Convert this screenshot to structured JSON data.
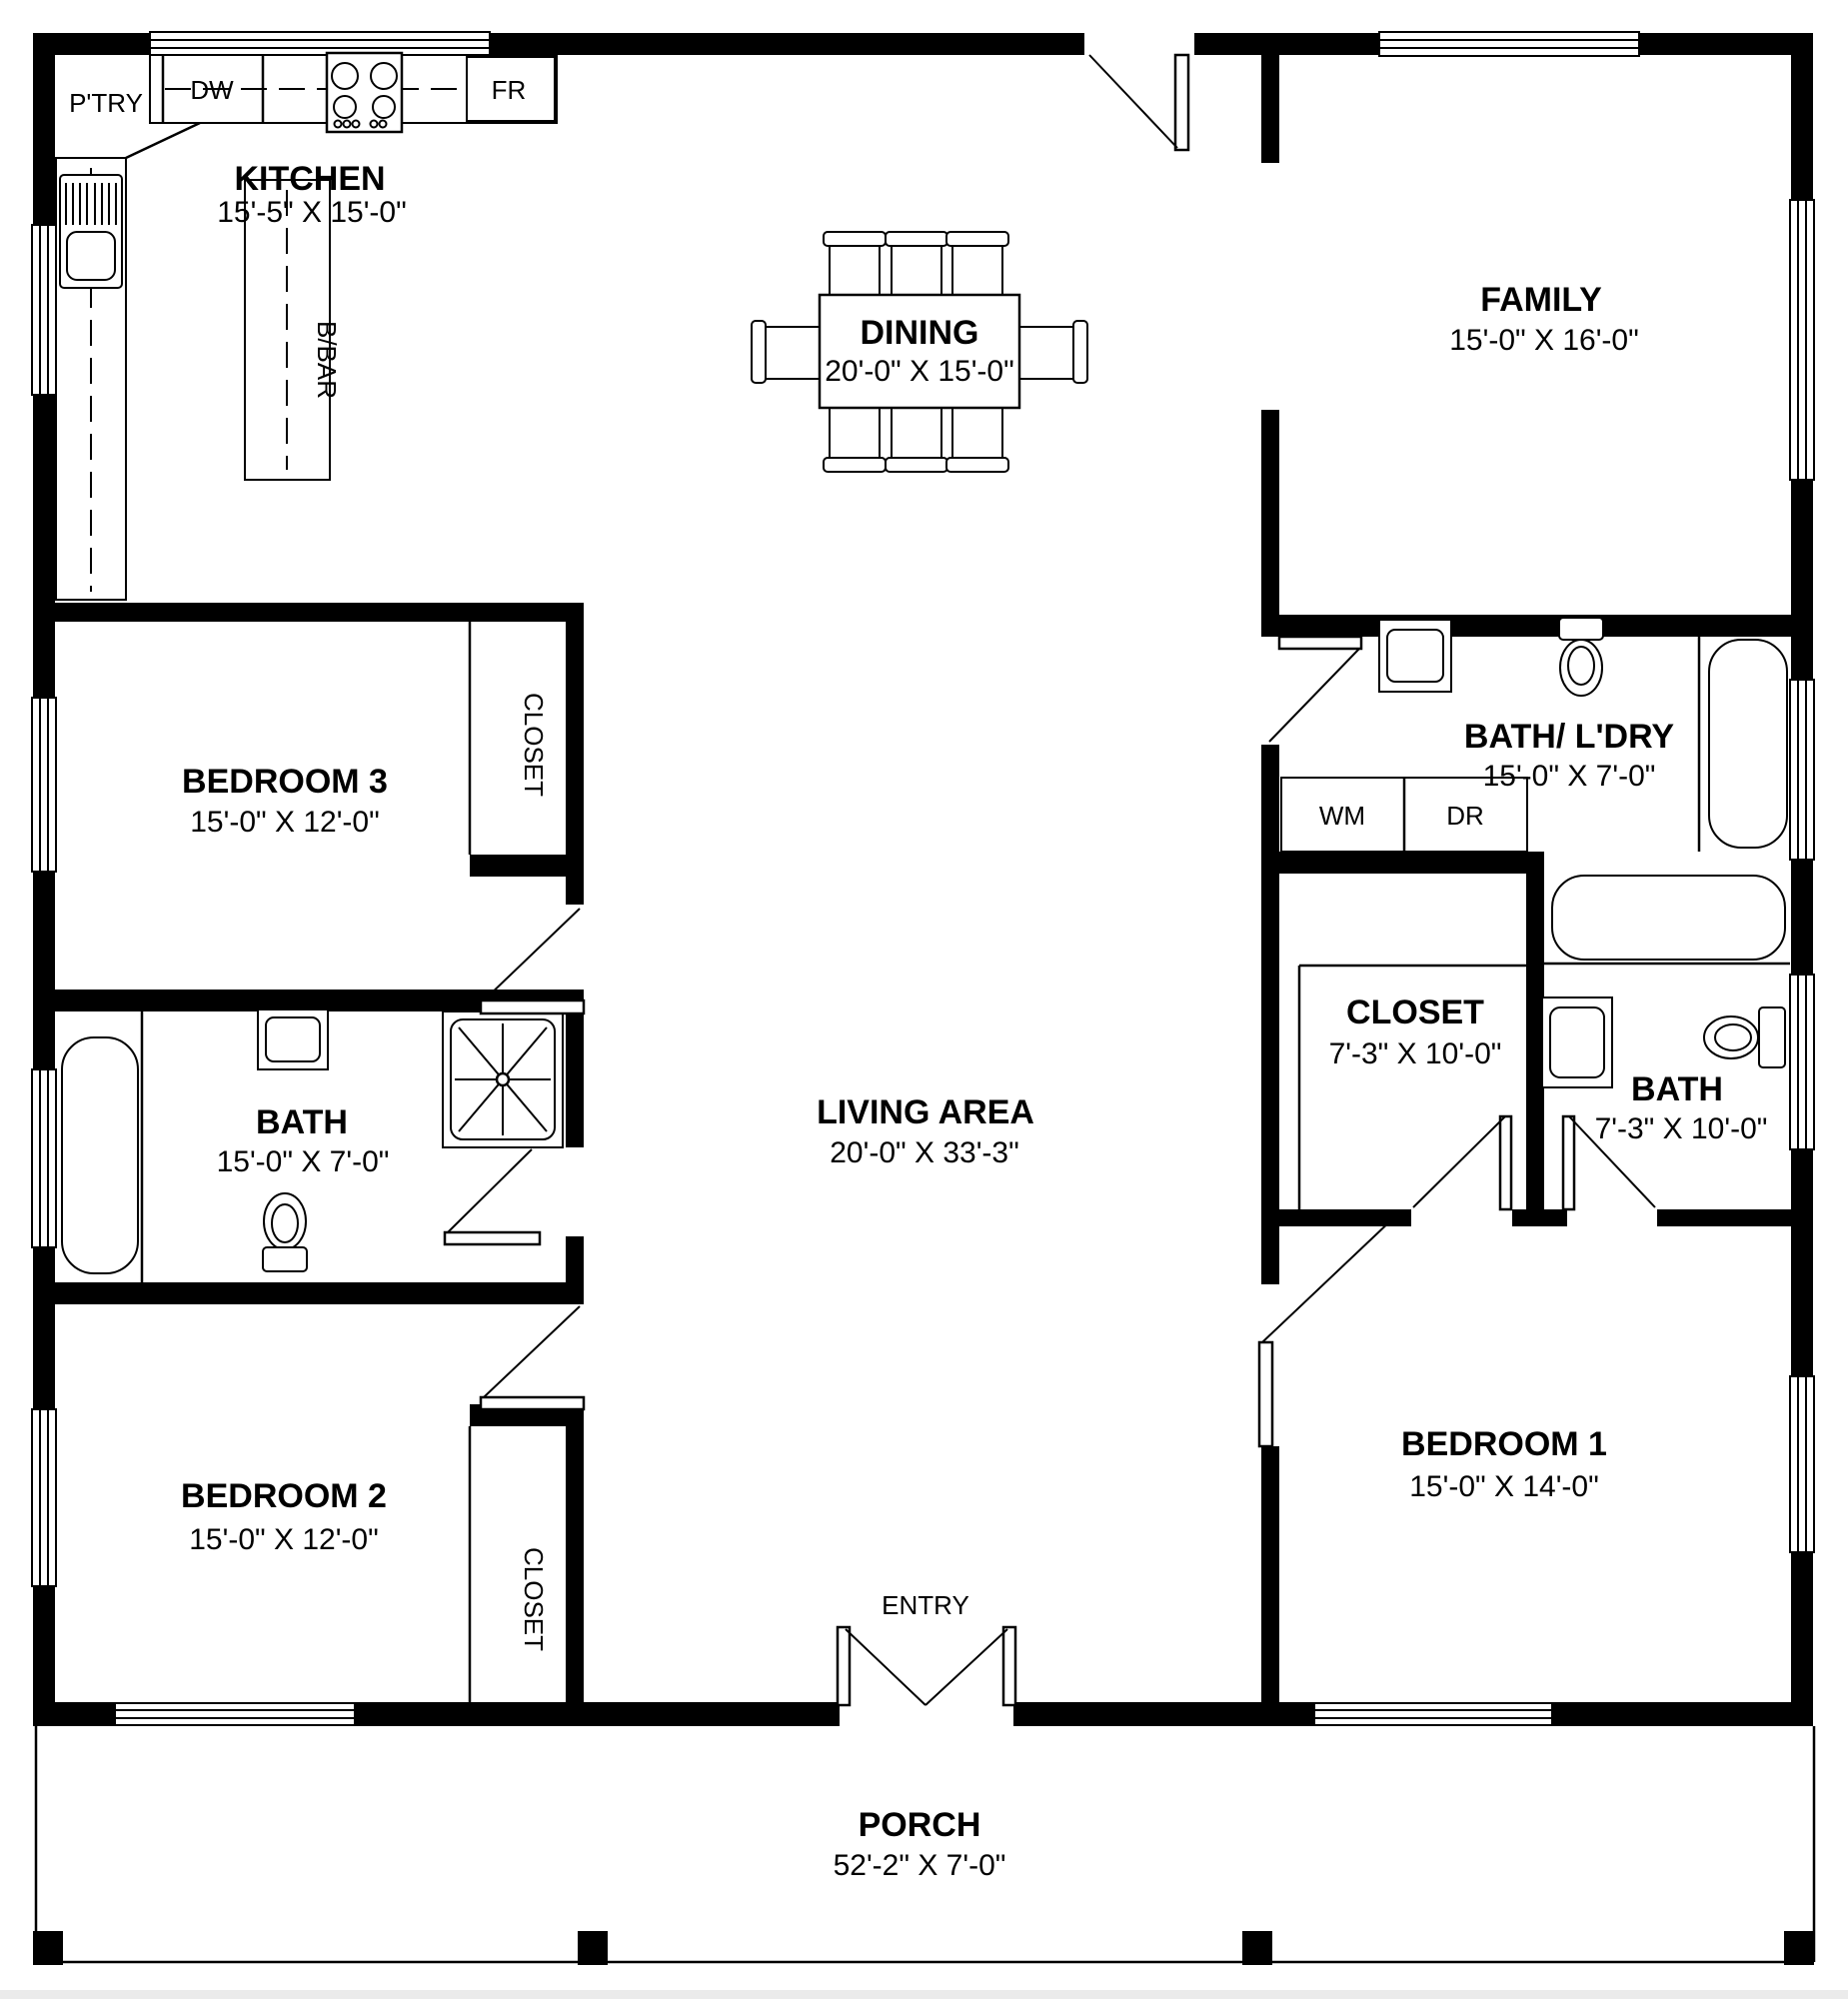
{
  "colors": {
    "wall": "#000000",
    "background": "#ffffff",
    "footer_strip": "#ebebeb"
  },
  "rooms": {
    "kitchen": {
      "name": "KITCHEN",
      "dims": "15'-5\" X 15'-0\""
    },
    "dining": {
      "name": "DINING",
      "dims": "20'-0\" X 15'-0\""
    },
    "family": {
      "name": "FAMILY",
      "dims": "15'-0\" X 16'-0\""
    },
    "bedroom3": {
      "name": "BEDROOM 3",
      "dims": "15'-0\" X 12'-0\""
    },
    "bath_main": {
      "name": "BATH",
      "dims": "15'-0\" X 7'-0\""
    },
    "bedroom2": {
      "name": "BEDROOM 2",
      "dims": "15'-0\" X 12'-0\""
    },
    "living": {
      "name": "LIVING AREA",
      "dims": "20'-0\" X 33'-3\""
    },
    "bath_laundry": {
      "name": "BATH/ L'DRY",
      "dims": "15'-0\" X 7'-0\""
    },
    "closet_master": {
      "name": "CLOSET",
      "dims": "7'-3\" X 10'-0\""
    },
    "bath_master": {
      "name": "BATH",
      "dims": "7'-3\" X 10'-0\""
    },
    "bedroom1": {
      "name": "BEDROOM 1",
      "dims": "15'-0\" X 14'-0\""
    },
    "porch": {
      "name": "PORCH",
      "dims": "52'-2\" X 7'-0\""
    }
  },
  "labels": {
    "pantry": "P'TRY",
    "dishwasher": "DW",
    "fridge": "FR",
    "breakfast_bar": "B/BAR",
    "washer": "WM",
    "dryer": "DR",
    "closet_bedroom3": "CLOSET",
    "closet_bedroom2": "CLOSET",
    "entry": "ENTRY"
  }
}
